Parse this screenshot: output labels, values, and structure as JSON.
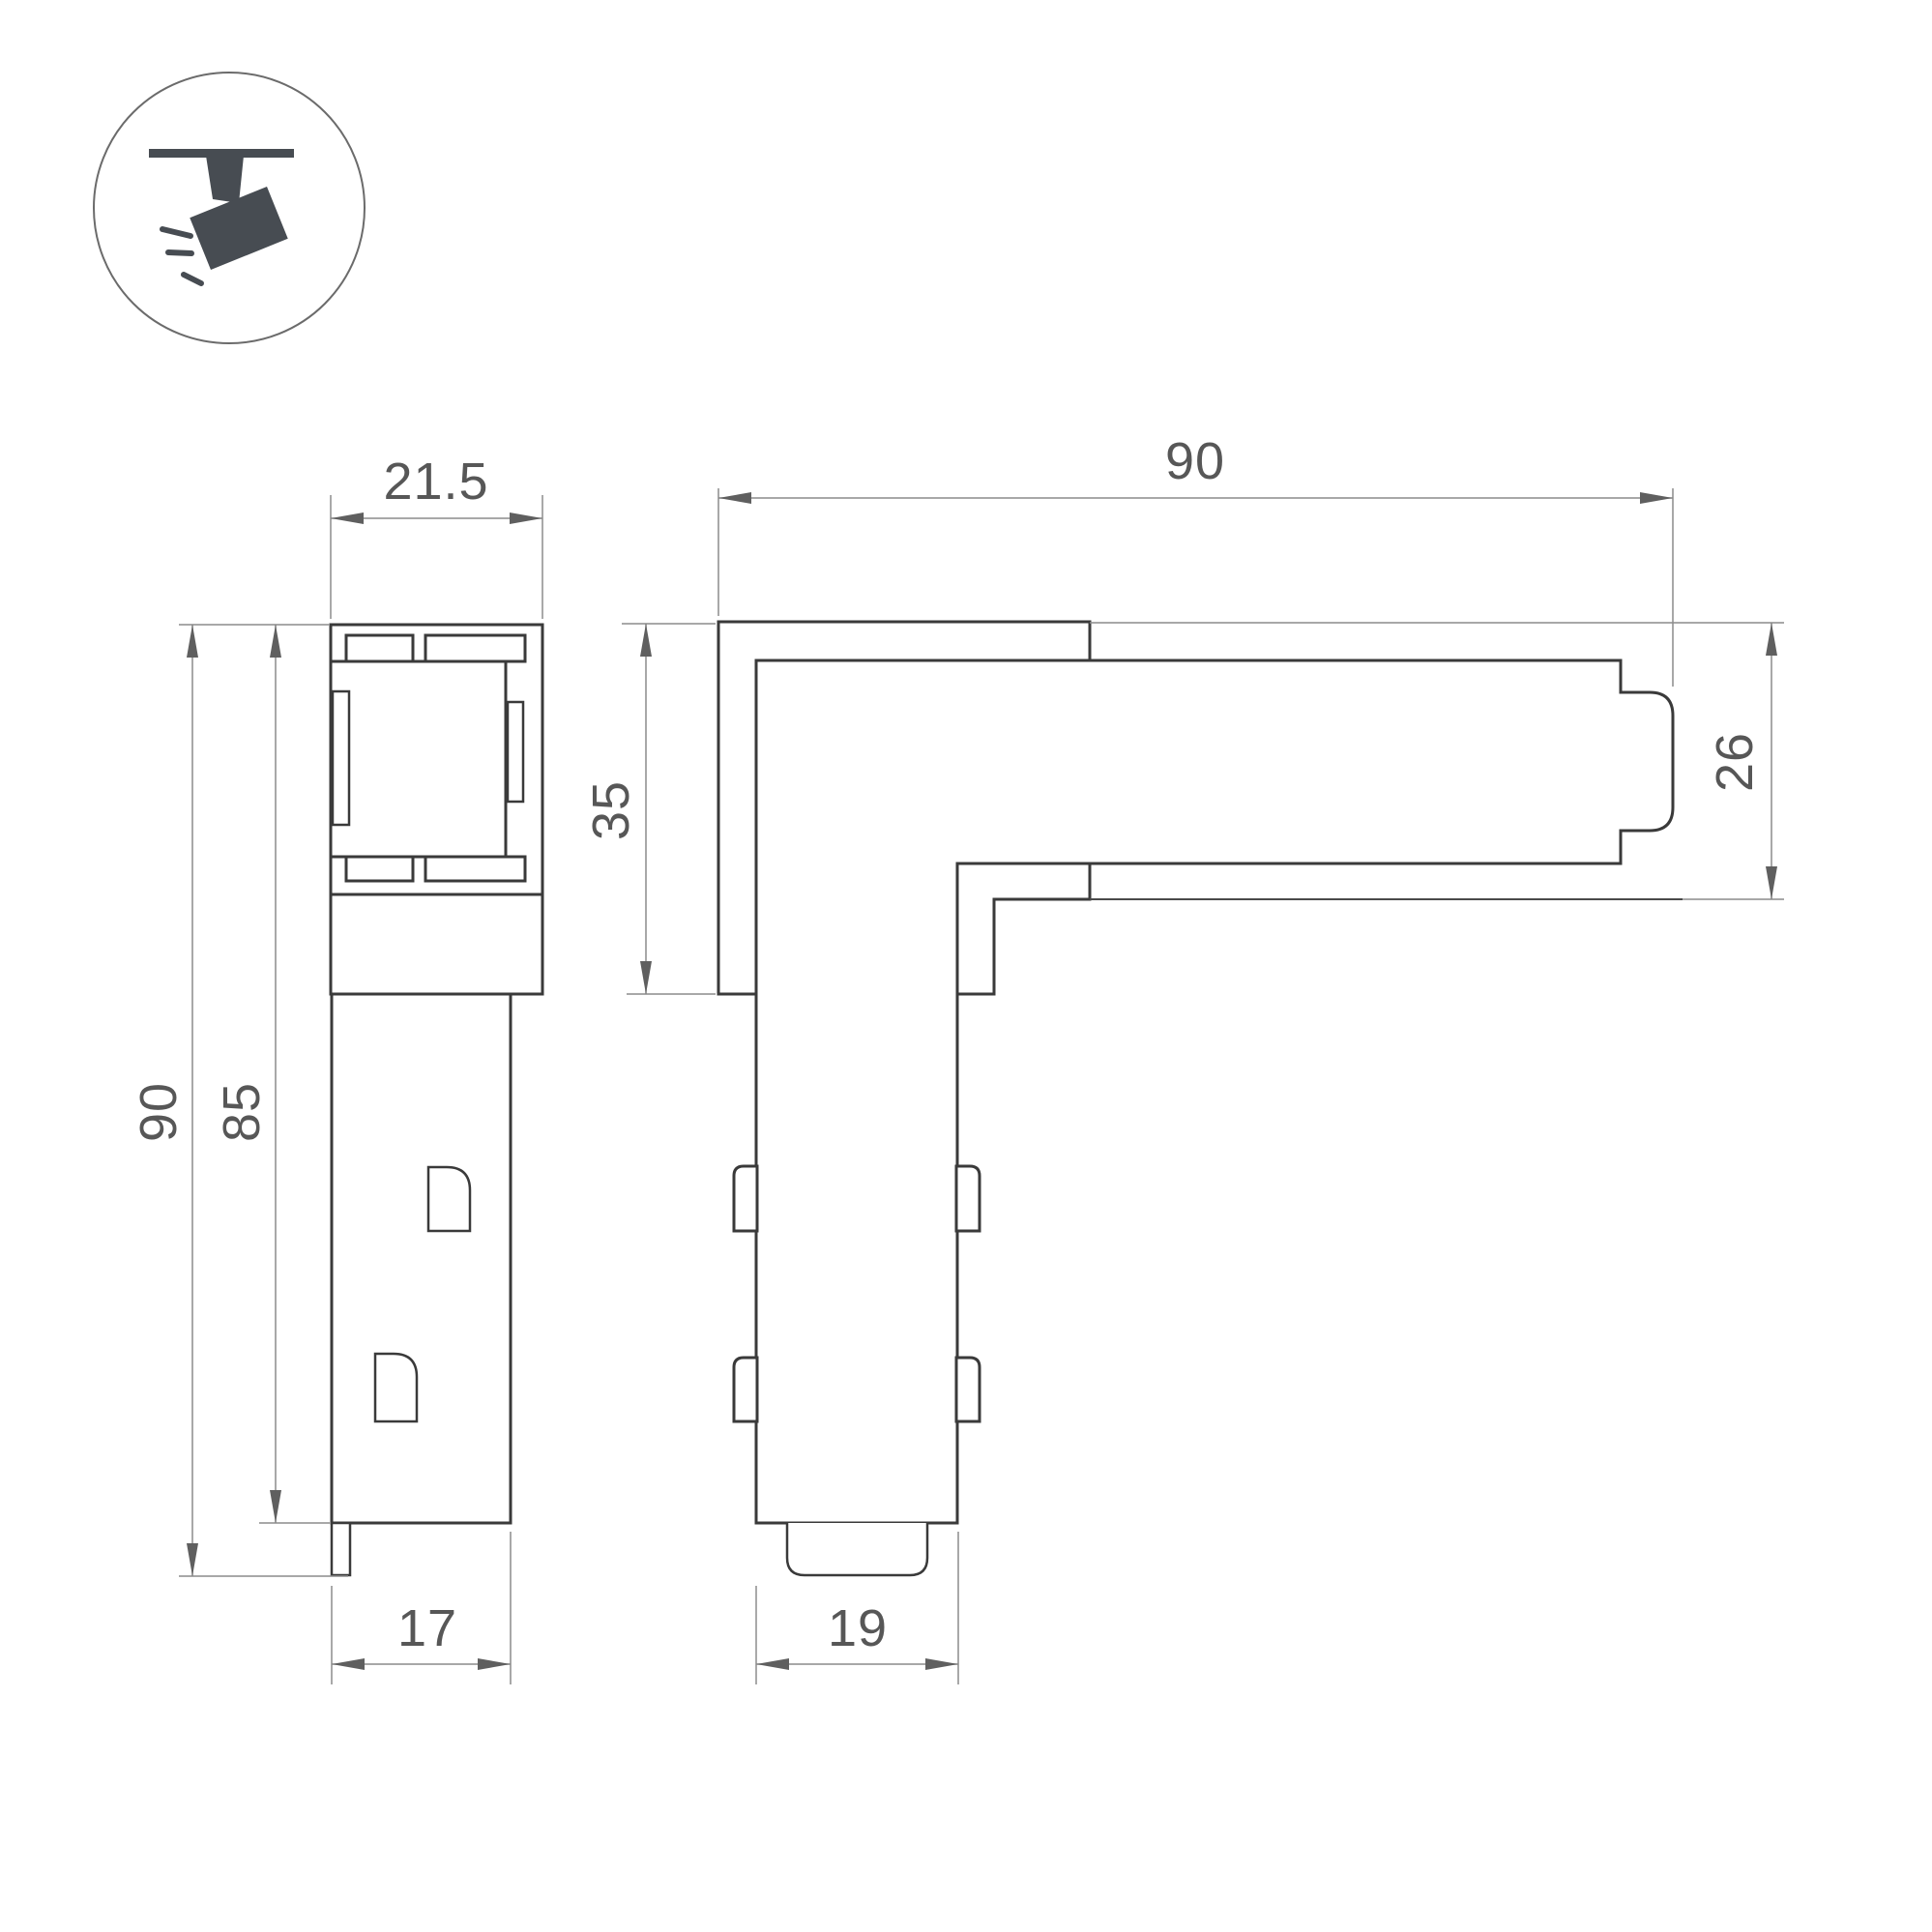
{
  "drawing": {
    "type": "technical-dimension-drawing",
    "subject": "L-shaped corner connector for magnetic track light profile",
    "units_implied": "mm",
    "colors": {
      "background": "#ffffff",
      "outline": "#3a3a3a",
      "dimension_line": "#8c8c8c",
      "arrow": "#5f5f5f",
      "text": "#575757",
      "icon_fill": "#474c52",
      "icon_circle_stroke": "#6b6b6b"
    },
    "icon": {
      "name": "track-spotlight-icon",
      "description": "ceiling track with tilted spotlight emitting rays, inside circle"
    },
    "side_view": {
      "label": "side profile view",
      "dim_top_width": "21.5",
      "dim_total_height": "90",
      "dim_body_height": "85",
      "dim_bottom_width": "17"
    },
    "front_view": {
      "label": "front L-shape view",
      "dim_total_width": "90",
      "dim_left_height": "35",
      "dim_right_height": "26",
      "dim_bottom_width": "19"
    }
  }
}
